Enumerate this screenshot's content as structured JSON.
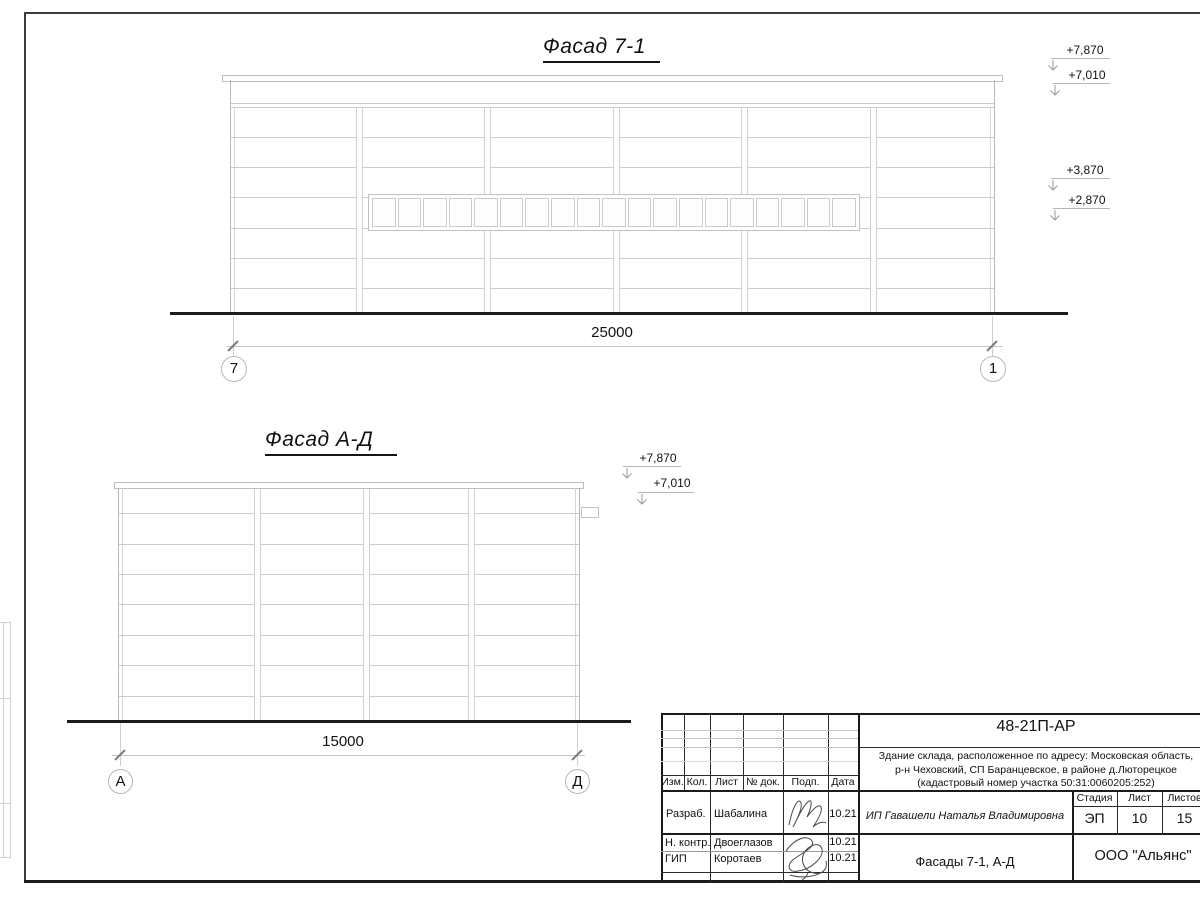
{
  "sheet": {
    "facade1": {
      "title": "Фасад 7-1",
      "dimension": "25000",
      "axis_left": "7",
      "axis_right": "1",
      "window_panes": 19,
      "elevations": [
        "+7,870",
        "+7,010",
        "+3,870",
        "+2,870"
      ]
    },
    "facade2": {
      "title": "Фасад А-Д",
      "dimension": "15000",
      "axis_left": "А",
      "axis_right": "Д",
      "elevations": [
        "+7,870",
        "+7,010"
      ]
    },
    "stamp": {
      "doc_number": "48-21П-АР",
      "description": [
        "Здание склада, расположенное по адресу: Московская область,",
        "р-н Чеховский, СП Баранцевское, в районе д.Люторецкое",
        "(кадастровый номер участка 50:31:0060205:252)"
      ],
      "columns": [
        "Изм.",
        "Кол.",
        "Лист",
        "№ док.",
        "Подп.",
        "Дата"
      ],
      "roles": [
        {
          "role": "Разраб.",
          "name": "Шабалина",
          "date": "10.21"
        },
        {
          "role": "Н. контр.",
          "name": "Двоеглазов",
          "date": "10.21"
        },
        {
          "role": "ГИП",
          "name": "Коротаев",
          "date": "10.21"
        }
      ],
      "client": "ИП Гавашели Наталья Владимировна",
      "stage_label": "Стадия",
      "sheet_label": "Лист",
      "sheets_label": "Листов",
      "stage": "ЭП",
      "sheet_no": "10",
      "sheets_total": "15",
      "sheet_title": "Фасады 7-1, А-Д",
      "company": "ООО \"Альянс\""
    },
    "colors": {
      "line_light": "#cdcdcd",
      "line_mid": "#b5b5b5",
      "line_dark": "#1b1b1b"
    }
  }
}
